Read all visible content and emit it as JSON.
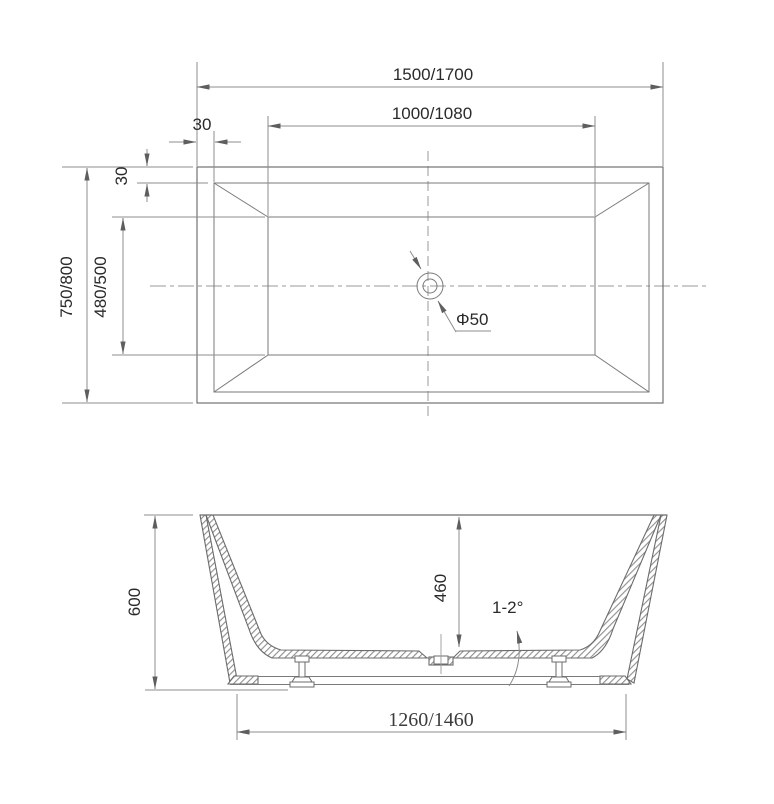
{
  "labels": {
    "plan": {
      "overall_length": "1500/1700",
      "basin_length": "1000/1080",
      "rim_width_top": "30",
      "rim_width_side": "30",
      "overall_width": "750/800",
      "basin_width": "480/500",
      "drain_diameter": "Φ50"
    },
    "section": {
      "overall_height": "600",
      "basin_depth": "460",
      "floor_slope": "1-2°",
      "base_length": "1260/1460"
    }
  }
}
